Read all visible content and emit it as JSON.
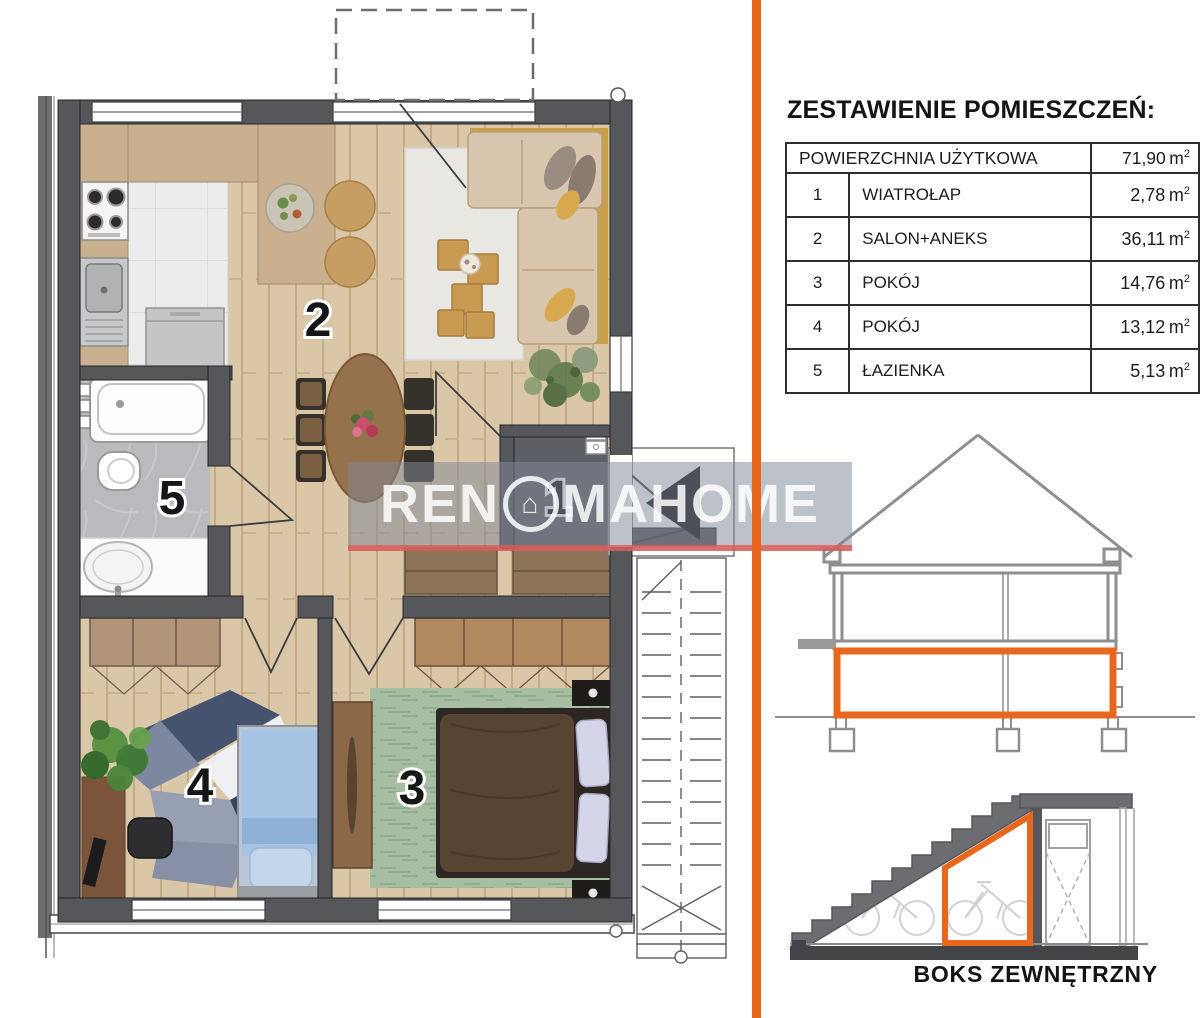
{
  "accent_color": "#e8671c",
  "watermark_line_color": "#e05a55",
  "watermark": {
    "left": "REN",
    "house_glyph": "⌂",
    "right": "MAHOME"
  },
  "legend": {
    "title": "ZESTAWIENIE POMIESZCZEŃ:",
    "total": {
      "label": "POWIERZCHNIA UŻYTKOWA",
      "area": "71,90"
    },
    "rows": [
      {
        "no": "1",
        "name": "WIATROŁAP",
        "area": "2,78"
      },
      {
        "no": "2",
        "name": "SALON+ANEKS",
        "area": "36,11"
      },
      {
        "no": "3",
        "name": "POKÓJ",
        "area": "14,76"
      },
      {
        "no": "4",
        "name": "POKÓJ",
        "area": "13,12"
      },
      {
        "no": "5",
        "name": "ŁAZIENKA",
        "area": "5,13"
      }
    ]
  },
  "units": {
    "base": "m",
    "sup": "2"
  },
  "boks": {
    "caption": "BOKS ZEWNĘTRZNY"
  }
}
